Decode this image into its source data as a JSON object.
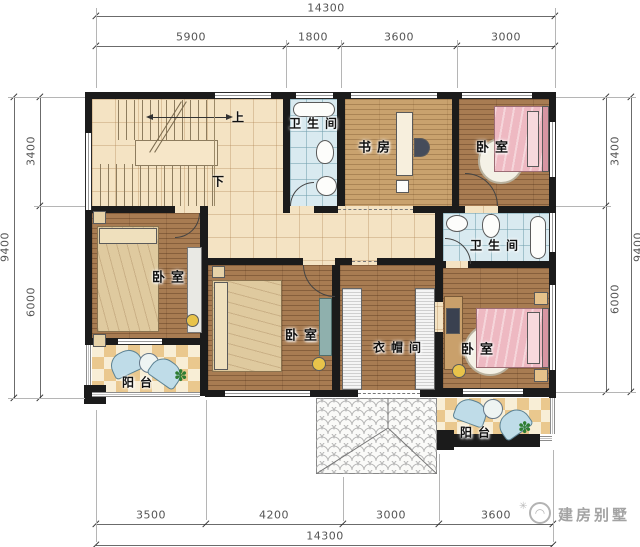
{
  "dimensions": {
    "top": {
      "overall": "14300",
      "segments": [
        "5900",
        "1800",
        "3600",
        "3000"
      ]
    },
    "bottom": {
      "overall": "14300",
      "segments": [
        "3500",
        "4200",
        "3000",
        "3600"
      ]
    },
    "left": {
      "overall": "9400",
      "segments": [
        "3400",
        "6000"
      ]
    },
    "right": {
      "overall": "9400",
      "segments": [
        "3400",
        "6000"
      ]
    }
  },
  "rooms": {
    "bath_top": "卫生间",
    "study": "书房",
    "bedroom_top_right": "卧室",
    "bath_mid": "卫生间",
    "bedroom_left": "卧室",
    "bedroom_center": "卧室",
    "cloakroom": "衣帽间",
    "bedroom_bottom_right": "卧室",
    "balcony_left": "阳台",
    "balcony_right": "阳台"
  },
  "stairs": {
    "up": "上",
    "down": "下"
  },
  "watermark": {
    "text": "建房别墅"
  },
  "colors": {
    "wall": "#1b1b1b",
    "wood": "#a87c52",
    "wood_light": "#c9a26e",
    "tile_cream": "#f4e3c3",
    "tile_blue": "#d9eaf0",
    "checker": "#eac88e",
    "bed_pink": "#eeb9c2",
    "dim_text": "#555555"
  }
}
